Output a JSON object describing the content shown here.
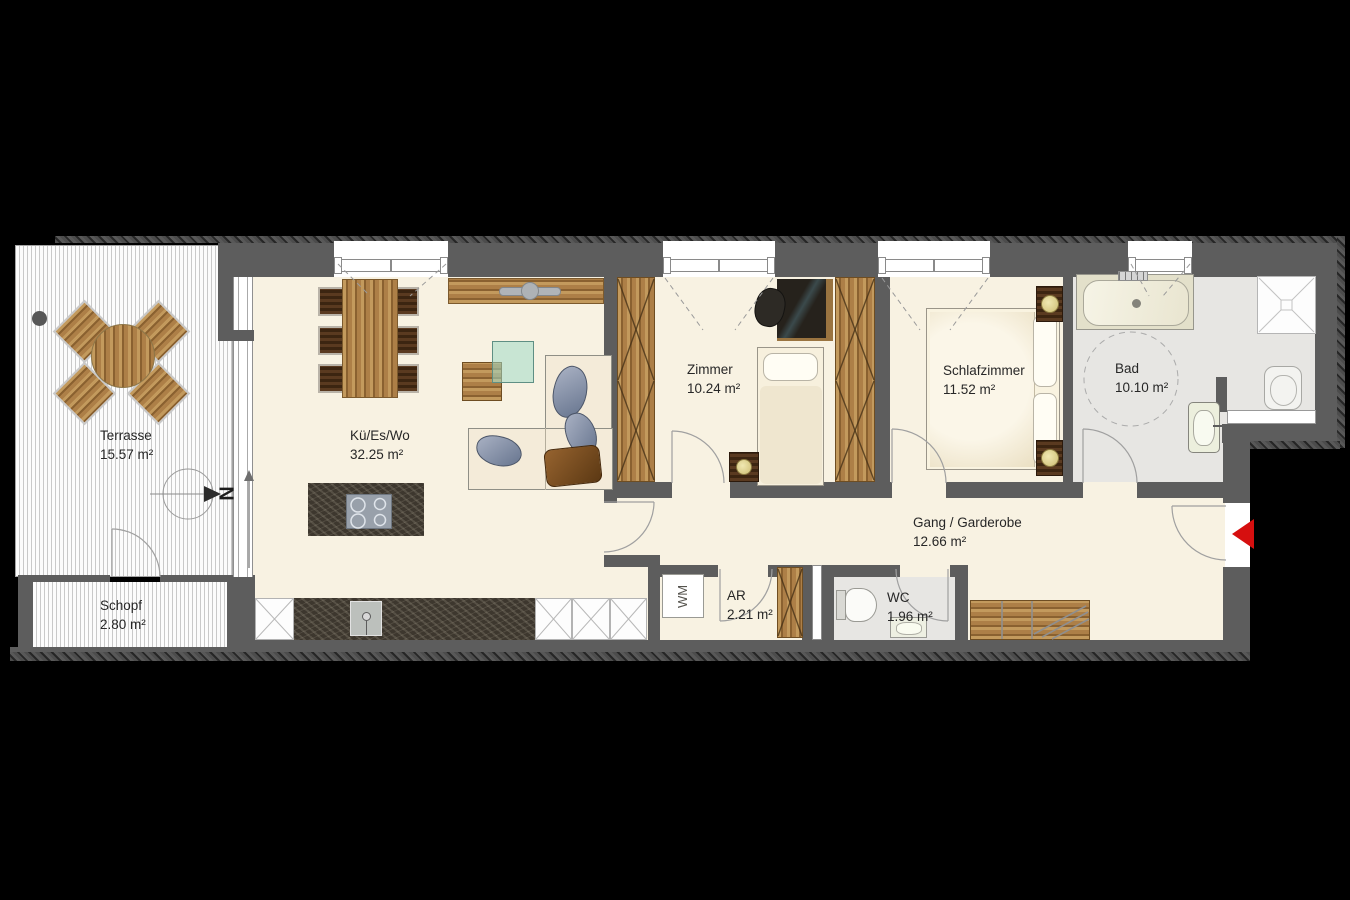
{
  "plan": {
    "rooms": [
      {
        "key": "terrasse",
        "name": "Terrasse",
        "area": "15.57 m²"
      },
      {
        "key": "kue_es_wo",
        "name": "Kü/Es/Wo",
        "area": "32.25 m²"
      },
      {
        "key": "zimmer",
        "name": "Zimmer",
        "area": "10.24 m²"
      },
      {
        "key": "schlafzimmer",
        "name": "Schlafzimmer",
        "area": "11.52 m²"
      },
      {
        "key": "bad",
        "name": "Bad",
        "area": "10.10 m²"
      },
      {
        "key": "gang",
        "name": "Gang / Garderobe",
        "area": "12.66 m²"
      },
      {
        "key": "schopf",
        "name": "Schopf",
        "area": "2.80 m²"
      },
      {
        "key": "ar",
        "name": "AR",
        "area": "2.21 m²"
      },
      {
        "key": "wc",
        "name": "WC",
        "area": "1.96 m²"
      }
    ],
    "markers": {
      "north_label": "N",
      "washing_machine_label": "WM"
    },
    "colors": {
      "wall": "#5d5d5d",
      "floor_cream": "#f8f2e2",
      "floor_wet": "#e7e6e3",
      "entry_arrow": "#d60f0f",
      "wood": "#a87c45"
    }
  }
}
